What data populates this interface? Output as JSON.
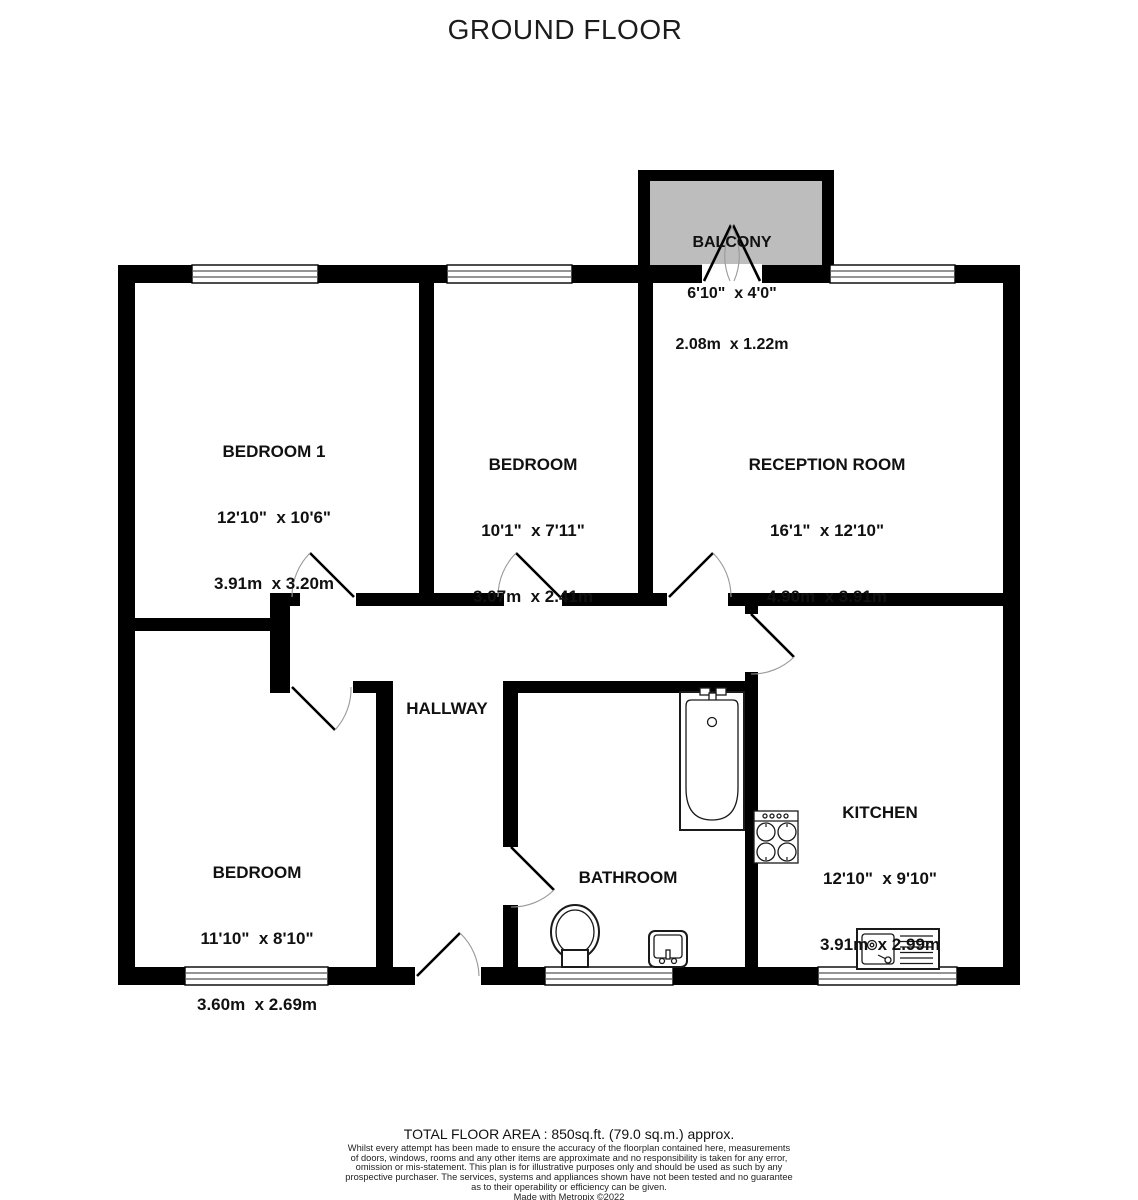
{
  "title": "GROUND FLOOR",
  "rooms": [
    {
      "id": "balcony",
      "name": "BALCONY",
      "imperial": "6'10\"  x 4'0\"",
      "metric": "2.08m  x 1.22m"
    },
    {
      "id": "bedroom-1",
      "name": "BEDROOM 1",
      "imperial": "12'10\"  x 10'6\"",
      "metric": "3.91m  x 3.20m"
    },
    {
      "id": "bedroom-middle",
      "name": "BEDROOM",
      "imperial": "10'1\"  x 7'11\"",
      "metric": "3.07m  x 2.41m"
    },
    {
      "id": "reception-room",
      "name": "RECEPTION ROOM",
      "imperial": "16'1\"  x 12'10\"",
      "metric": "4.90m  x 3.91m"
    },
    {
      "id": "hallway",
      "name": "HALLWAY"
    },
    {
      "id": "bedroom-lower",
      "name": "BEDROOM",
      "imperial": "11'10\"  x 8'10\"",
      "metric": "3.60m  x 2.69m"
    },
    {
      "id": "bathroom",
      "name": "BATHROOM"
    },
    {
      "id": "kitchen",
      "name": "KITCHEN",
      "imperial": "12'10\"  x 9'10\"",
      "metric": "3.91m  x 2.99m"
    }
  ],
  "footer": {
    "total_area": "TOTAL FLOOR AREA : 850sq.ft. (79.0 sq.m.) approx.",
    "disclaimer": "Whilst every attempt has been made to ensure the accuracy of the floorplan contained here, measurements\nof doors, windows, rooms and any other items are approximate and no responsibility is taken for any error,\nomission or mis-statement. This plan is for illustrative purposes only and should be used as such by any\nprospective purchaser. The services, systems and appliances shown have not been tested and no guarantee\nas to their operability or efficiency can be given.",
    "credit": "Made with Metropix ©2022"
  },
  "colors": {
    "wall": "#000000",
    "balcony_fill": "#bdbdbd",
    "door_arc": "#999999"
  }
}
